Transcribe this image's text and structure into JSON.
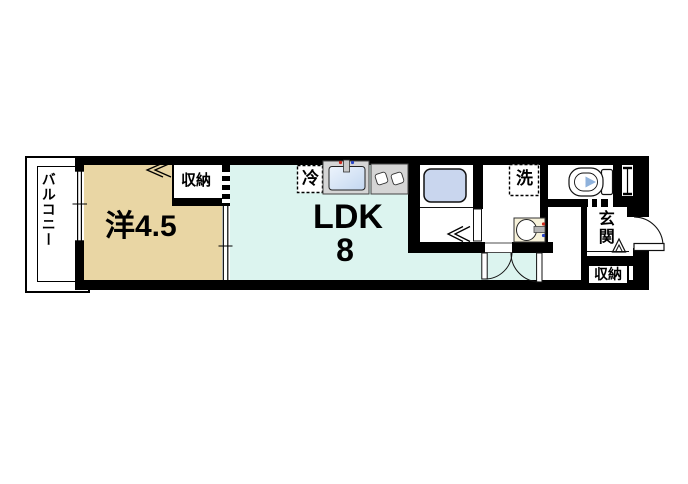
{
  "labels": {
    "balcony": "バルコニー",
    "western_room": "洋4.5",
    "closet": "収納",
    "ldk": "LDK",
    "ldk_size": "8",
    "refrigerator": "冷",
    "laundry": "洗",
    "entrance": "玄関",
    "entrance_closet": "収納"
  },
  "colors": {
    "wall": "#000000",
    "western_room_fill": "#E9D6A4",
    "ldk_fill": "#DCF4EF",
    "bathtub_fill": "#C9D6EE",
    "counter_fill": "#D5D5D5",
    "basin_fill": "#F7F2DA",
    "toilet_seat_fill": "#8FB2DC",
    "hot_tap": "#CC2A1E",
    "cold_tap": "#2A46C8",
    "sink_fill_light": "#EDF4FC",
    "sink_fill": "#C3D7F0"
  }
}
